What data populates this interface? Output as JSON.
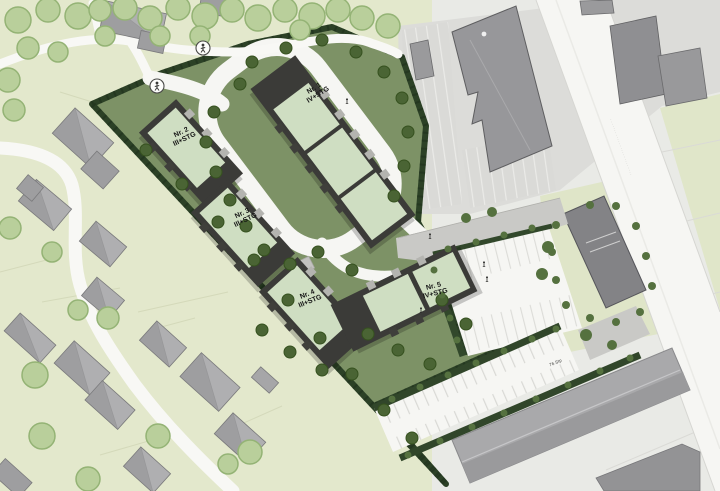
{
  "labels": {
    "b1": {
      "line1": "Nr. 1",
      "line2": "IV+STG"
    },
    "b2": {
      "line1": "Nr. 2",
      "line2": "III+STG"
    },
    "b3": {
      "line1": "Nr. 3",
      "line2": "III+STG"
    },
    "b4": {
      "line1": "Nr. 4",
      "line2": "III+STG"
    },
    "b5": {
      "line1": "Nr. 5",
      "line2": "IV+STG"
    },
    "street_name": "··························",
    "parking_count": "76 Stp"
  },
  "colors": {
    "site_lawn": "#7d9266",
    "hedge_green": "#2c4126",
    "roof_green": "#cfdec2",
    "new_building_dark": "#3b3b38",
    "existing_building_gray": "#9e9ea0",
    "road_white": "#f6f6f3",
    "pale_green": "#e3e8cc",
    "paved_gray": "#dcdcd9"
  }
}
